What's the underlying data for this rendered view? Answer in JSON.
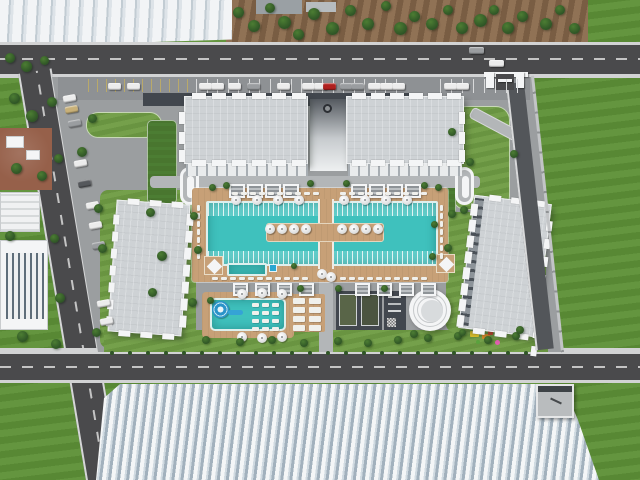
{
  "scene": {
    "type": "aerial-architectural-render",
    "description": "Bird's-eye 3D visualization of a gated residential complex: four light-grey apartment blocks around a landscaped courtyard with a large twin swimming pool, sun decks, cabanas, a children's pool with spiral water slide, sports courts and a circular plaza; perimeter roads with parked cars, a gated entrance, industrial greenhouses at the top-left and bottom, and open green fields to the right",
    "site": {
      "apartment_blocks": 4,
      "greenhouses": 2,
      "main_pool_sections": 2,
      "children_pools": 2,
      "water_slide": 1,
      "cabanas_north": 8,
      "pergolas_south": 8,
      "sun_umbrellas": 24,
      "sports_courts": 2,
      "outdoor_gym_areas": 1,
      "circular_plazas": 1,
      "playgrounds": 1,
      "oval_garden_features": 2,
      "fountain_squares": 2,
      "gated_entrances": 1,
      "parked_cars_approx": 30
    },
    "amenities": [
      "main swimming pool with lap lanes",
      "central timber sun deck with umbrellas",
      "children's pool with spiral slide",
      "sun loungers",
      "cabanas and pergolas",
      "sports courts",
      "outdoor gym",
      "circular plaza",
      "playground",
      "landscaped gardens",
      "surface parking",
      "gated entrance"
    ]
  },
  "palette": {
    "road": "#4a4a4c",
    "roadDash": "#c4c4c4",
    "sidewalk": "#d2d3d4",
    "fieldGreen": "#5e9137",
    "lawnGreen": "#6f9c44",
    "darkLawn": "#49762f",
    "treeGreen": "#2f5526",
    "treeLight": "#4c7d33",
    "dirt": "#8a6a4c",
    "dirtRed": "#96604a",
    "pave": "#9b9ea0",
    "paveDark": "#42474e",
    "paveLight": "#b3b6b8",
    "roofGray": "#ced2d5",
    "white": "#f4f5f6",
    "facade": "#e9ebec",
    "deckTan": "#c7a077",
    "pool": "#3fc1bd",
    "carWhite": "#ececec",
    "carGray": "#9a9da0",
    "carDark": "#55585c",
    "carRed": "#b0201f",
    "carTan": "#c8b078",
    "courtGreen": "#596548",
    "courtDark": "#4b5440",
    "wallGray": "#c2c4c6",
    "playYellow": "#e0c32a",
    "playPink": "#e060b0",
    "playOrange": "#d98b2b",
    "playRed": "#cc4632",
    "slideBlue": "#2a93c9"
  }
}
